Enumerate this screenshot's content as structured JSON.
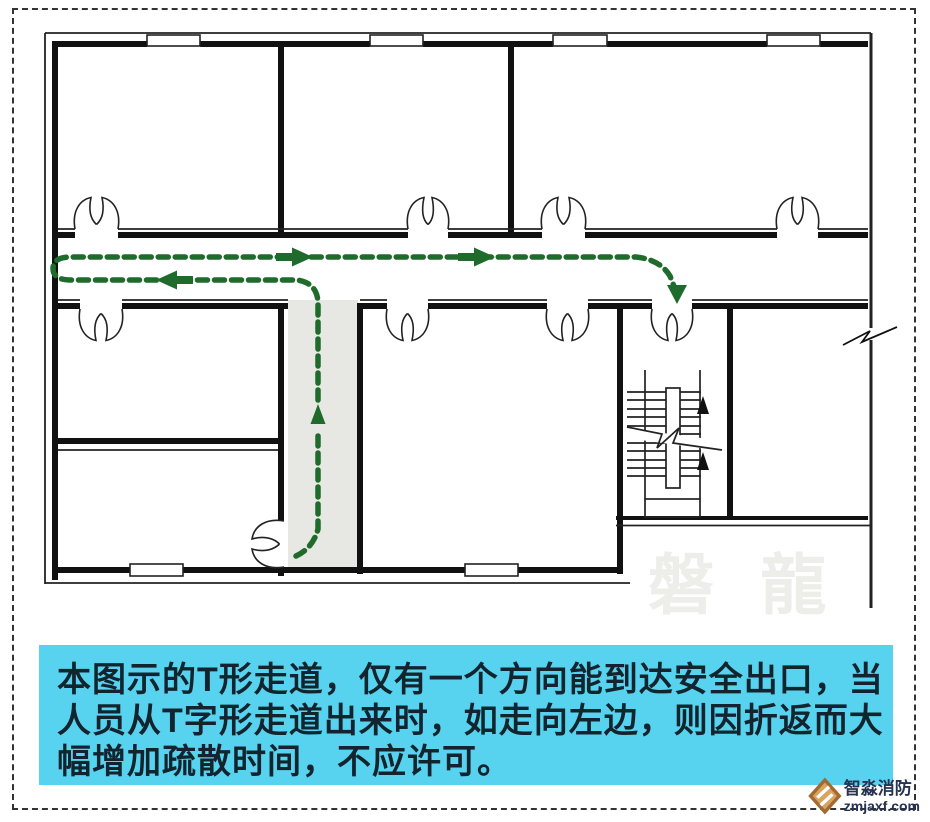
{
  "plan": {
    "colors": {
      "wall": "#111111",
      "door_stroke": "#222222",
      "route_green": "#1e6b2c",
      "stem_corridor_fill": "#e7e7e4",
      "stair_arrow": "#111111"
    },
    "symbols": [
      "double-leaf-door",
      "window",
      "staircase",
      "wall-break-mark",
      "evacuation-route-dashed-arrow",
      "t-corridor-stem-highlight"
    ]
  },
  "watermark": {
    "text": "磐 龍",
    "color": "#ededea"
  },
  "caption": {
    "bg": "#58d3ef",
    "text_color": "#12252f",
    "lines": [
      "本图示的T形走道，仅有一个方向能到达安全出口，当",
      "人员从T字形走道出来时，如走向左边，则因折返而大",
      "幅增加疏散时间，不应许可。"
    ]
  },
  "brand": {
    "title": "智淼消防",
    "url": "zmjaxf.com",
    "icon": "fire-brand-diamond-icon",
    "icon_color": "#b07a3e",
    "text_color": "#253252"
  }
}
